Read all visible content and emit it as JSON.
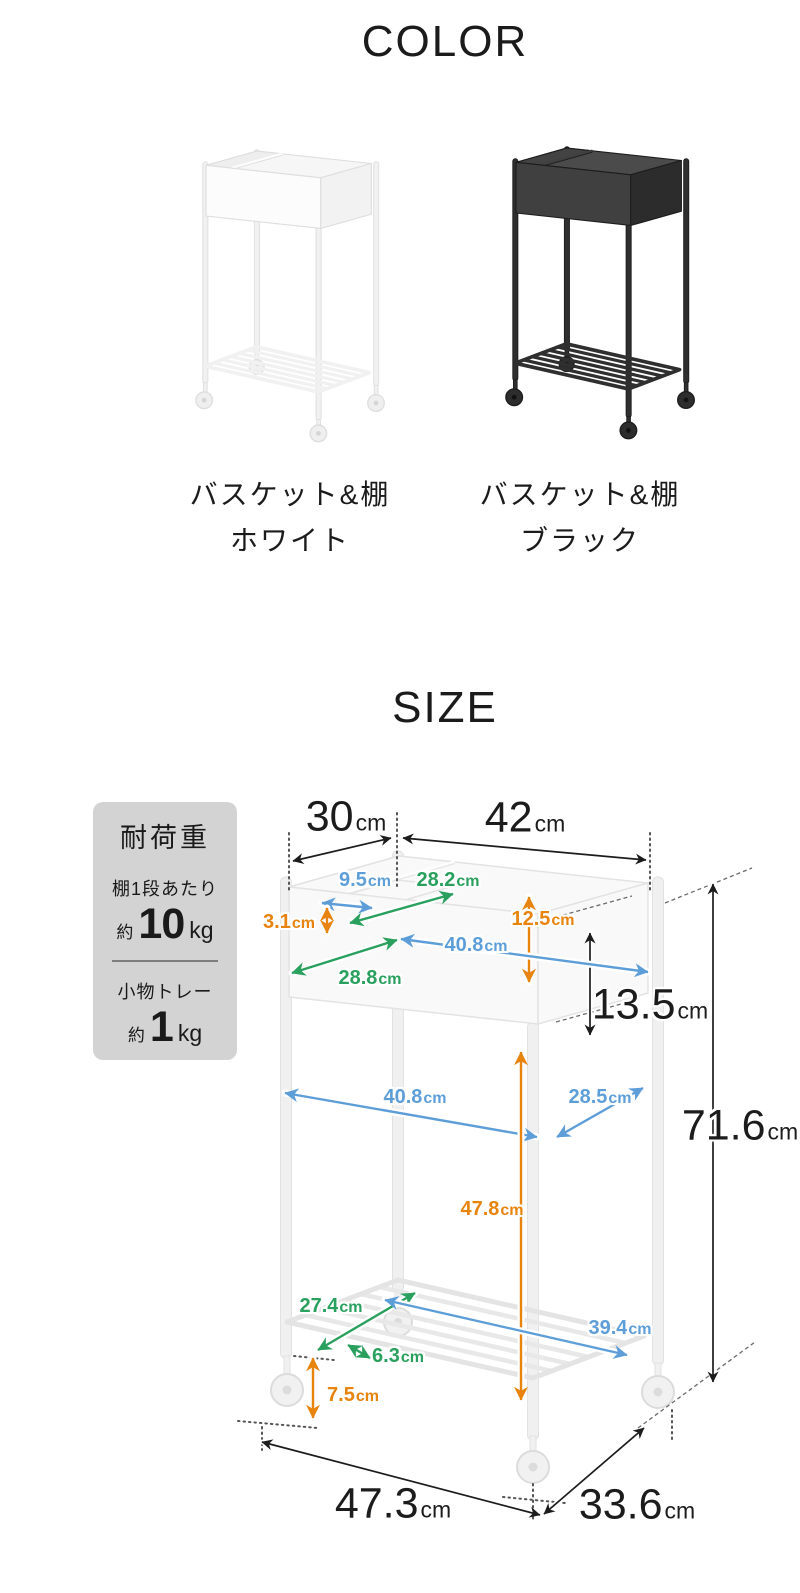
{
  "color_section": {
    "title": "COLOR",
    "variants": [
      {
        "line1": "バスケット&棚",
        "line2": "ホワイト",
        "color_hex": "#ffffff"
      },
      {
        "line1": "バスケット&棚",
        "line2": "ブラック",
        "color_hex": "#3a3a3a"
      }
    ]
  },
  "size_section": {
    "title": "SIZE",
    "load_capacity": {
      "title": "耐荷重",
      "items": [
        {
          "label": "棚1段あたり",
          "approx": "約",
          "value": "10",
          "unit": "kg"
        },
        {
          "label": "小物トレー",
          "approx": "約",
          "value": "1",
          "unit": "kg"
        }
      ]
    },
    "dimensions": [
      {
        "id": "top-depth",
        "value": "30",
        "unit": "cm",
        "color": "black"
      },
      {
        "id": "top-width",
        "value": "42",
        "unit": "cm",
        "color": "black"
      },
      {
        "id": "tray-width",
        "value": "9.5",
        "unit": "cm",
        "color": "blue"
      },
      {
        "id": "basket-inner-depth",
        "value": "28.2",
        "unit": "cm",
        "color": "green"
      },
      {
        "id": "tray-height",
        "value": "3.1",
        "unit": "cm",
        "color": "orange"
      },
      {
        "id": "basket-inner-height",
        "value": "12.5",
        "unit": "cm",
        "color": "orange"
      },
      {
        "id": "basket-inner-width",
        "value": "40.8",
        "unit": "cm",
        "color": "blue"
      },
      {
        "id": "basket-outer-depth",
        "value": "28.8",
        "unit": "cm",
        "color": "green"
      },
      {
        "id": "basket-height",
        "value": "13.5",
        "unit": "cm",
        "color": "black"
      },
      {
        "id": "leg-span-width",
        "value": "40.8",
        "unit": "cm",
        "color": "blue"
      },
      {
        "id": "leg-span-depth",
        "value": "28.5",
        "unit": "cm",
        "color": "blue"
      },
      {
        "id": "total-height",
        "value": "71.6",
        "unit": "cm",
        "color": "black"
      },
      {
        "id": "under-basket-height",
        "value": "47.8",
        "unit": "cm",
        "color": "orange"
      },
      {
        "id": "shelf-depth",
        "value": "27.4",
        "unit": "cm",
        "color": "green"
      },
      {
        "id": "shelf-width",
        "value": "39.4",
        "unit": "cm",
        "color": "blue"
      },
      {
        "id": "shelf-bar-pitch",
        "value": "6.3",
        "unit": "cm",
        "color": "green"
      },
      {
        "id": "caster-height",
        "value": "7.5",
        "unit": "cm",
        "color": "orange"
      },
      {
        "id": "base-width",
        "value": "47.3",
        "unit": "cm",
        "color": "black"
      },
      {
        "id": "base-depth",
        "value": "33.6",
        "unit": "cm",
        "color": "black"
      }
    ],
    "annotation_colors": {
      "blue": "#5e9ed8",
      "green": "#2aa05e",
      "orange": "#e8830d",
      "black": "#1c1c1c"
    }
  }
}
